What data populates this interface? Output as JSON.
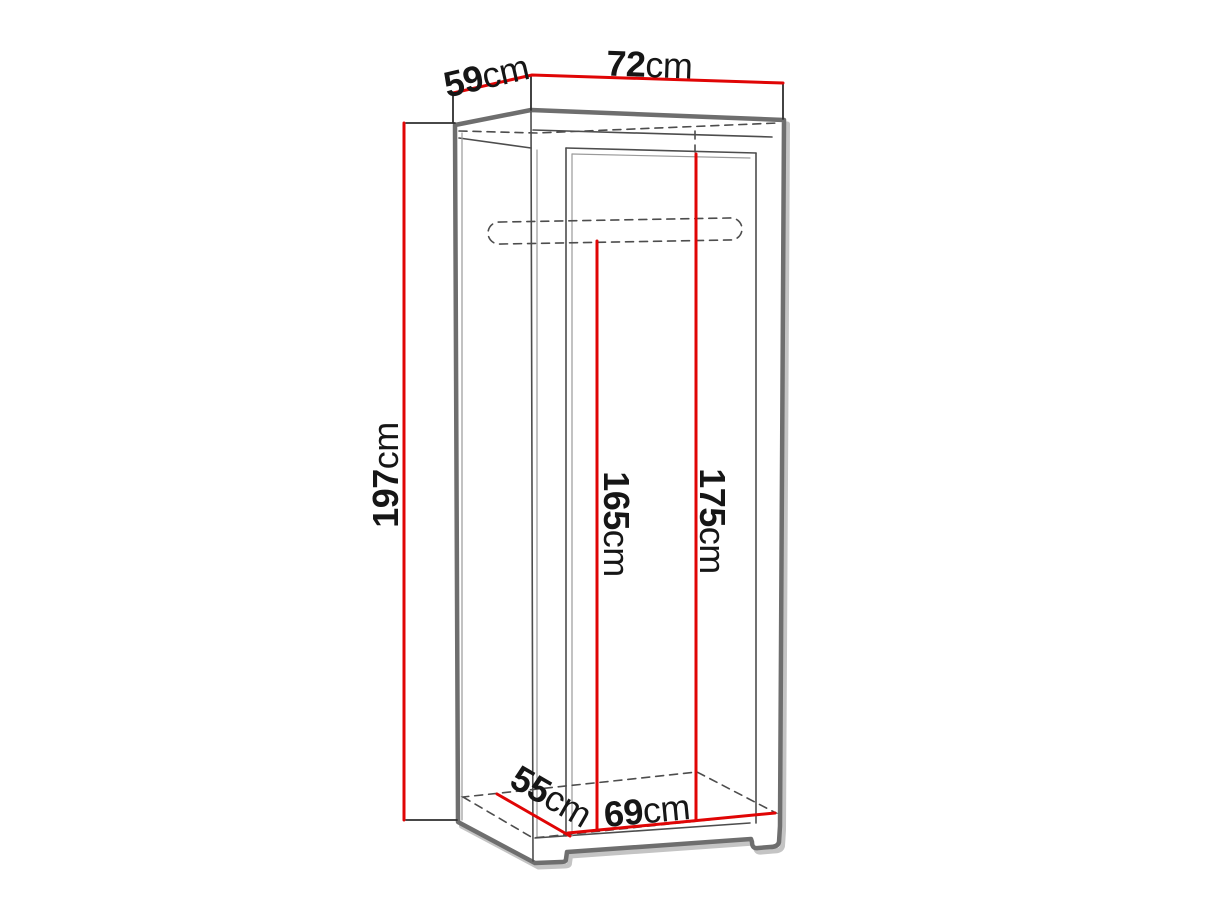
{
  "diagram": {
    "subject": "wardrobe dimension drawing",
    "colors": {
      "background": "#ffffff",
      "dimension_red": "#e00505",
      "outline_gray": "#6e6e6e",
      "outline_shadow_gray": "#c4c4c4",
      "detail_gray": "#4d4d4d",
      "light_gray": "#9a9a9a",
      "text": "#161616"
    },
    "labels": {
      "depth_top": {
        "value": "59",
        "unit": "cm"
      },
      "width_top": {
        "value": "72",
        "unit": "cm"
      },
      "height_total": {
        "value": "197",
        "unit": "cm"
      },
      "height_to_rail": {
        "value": "165",
        "unit": "cm"
      },
      "height_interior": {
        "value": "175",
        "unit": "cm"
      },
      "depth_interior": {
        "value": "55",
        "unit": "cm"
      },
      "width_interior": {
        "value": "69",
        "unit": "cm"
      }
    }
  }
}
